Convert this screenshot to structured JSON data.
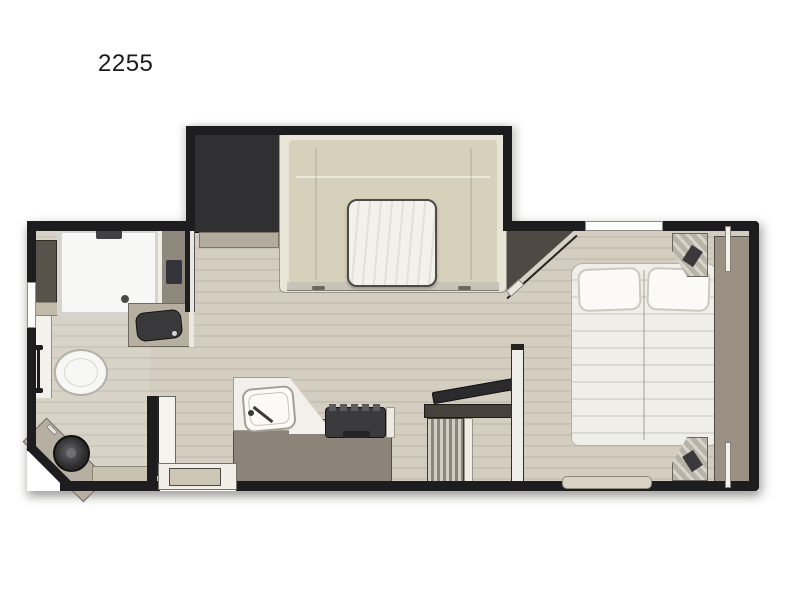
{
  "title": "2255",
  "colors": {
    "bg": "#ffffff",
    "wall": "#1d1d1f",
    "floor": "#d1cbbd",
    "sofa": "#d7d1bb",
    "sofa-trim": "#e8e5d6",
    "table": "#f3f1ec",
    "fridge": "#303033",
    "counter": "#b7afa1",
    "counter-white": "#f1f0ea",
    "cabinet": "#8e887d",
    "kitchen-cab": "#8c8478",
    "stove": "#3b3b3e",
    "fixture-white": "#f7f7f5",
    "sink-dark": "#39393c",
    "bed": "#f0eee8",
    "pillow": "#fbfaf7",
    "wardrobe": "#9a9184",
    "closet-dark": "#4e4a43",
    "console": "#46423b",
    "tv": "#2b2b2e",
    "louver-light": "#d2cdc3",
    "louver-dark": "#8b867d",
    "partition": "#f0eeea",
    "bench": "#d8d3c4",
    "shower-frame": "#d6d4cf",
    "step-tray": "#cdc6b4",
    "door": "#f4f3ee",
    "shadow": "rgba(90,88,82,0.45)"
  }
}
